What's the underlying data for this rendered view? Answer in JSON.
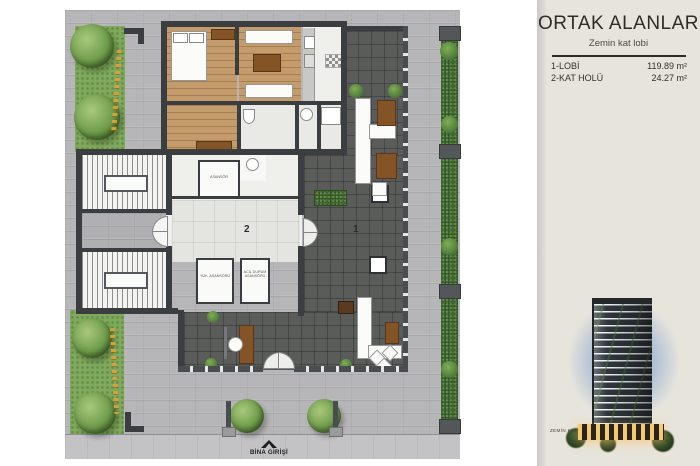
{
  "panel": {
    "title": "ORTAK ALANLAR",
    "subtitle": "Zemin kat lobi",
    "areas": [
      {
        "label": "1-LOBİ",
        "value": "119.89 m²"
      },
      {
        "label": "2-KAT HOLÜ",
        "value": "24.27 m²"
      }
    ],
    "floor_caption": "ZEMİN KAT"
  },
  "plan": {
    "entrance_label": "BİNA GİRİŞİ",
    "marker_lobby": "1",
    "marker_hall": "2",
    "room_labels": {
      "elevator": "ASANSÖR",
      "service_elevator": "YÜK. ASANSÖRÜ",
      "emergency_elevator": "ACİL DURUM ASANSÖRÜ"
    }
  },
  "colors": {
    "panel_bg": "#e7e4dc",
    "pavement": "#b6b6b8",
    "lobby_floor": "#5a5c5a",
    "hall_floor": "#e4e4e1",
    "wood_floor": "#c49c6b",
    "grass": "#7fa95c",
    "hedge": "#4c7736",
    "wall": "#3b3e41",
    "accent_flowers": "#d6a13a"
  }
}
